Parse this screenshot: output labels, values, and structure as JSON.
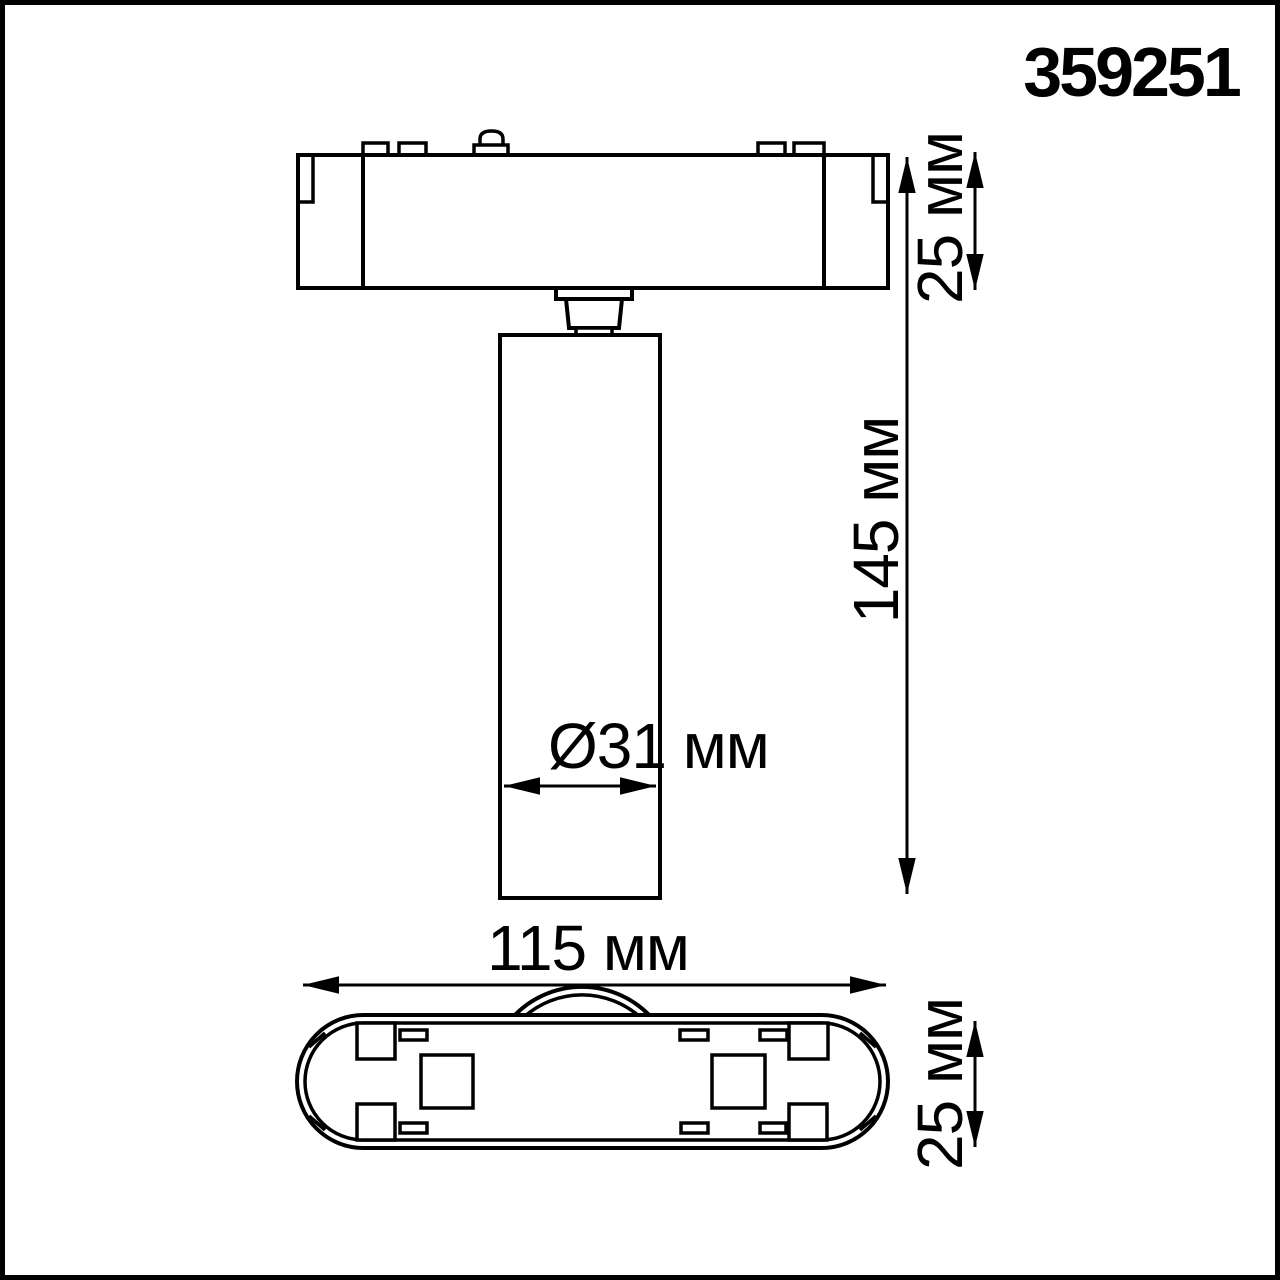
{
  "product_number": "359251",
  "colors": {
    "ink": "#000000",
    "background": "#ffffff"
  },
  "dimensions": {
    "adapter_height": "25 мм",
    "total_height": "145 мм",
    "diameter": "Ø31 мм",
    "base_width": "115 мм",
    "base_depth": "25 мм"
  }
}
